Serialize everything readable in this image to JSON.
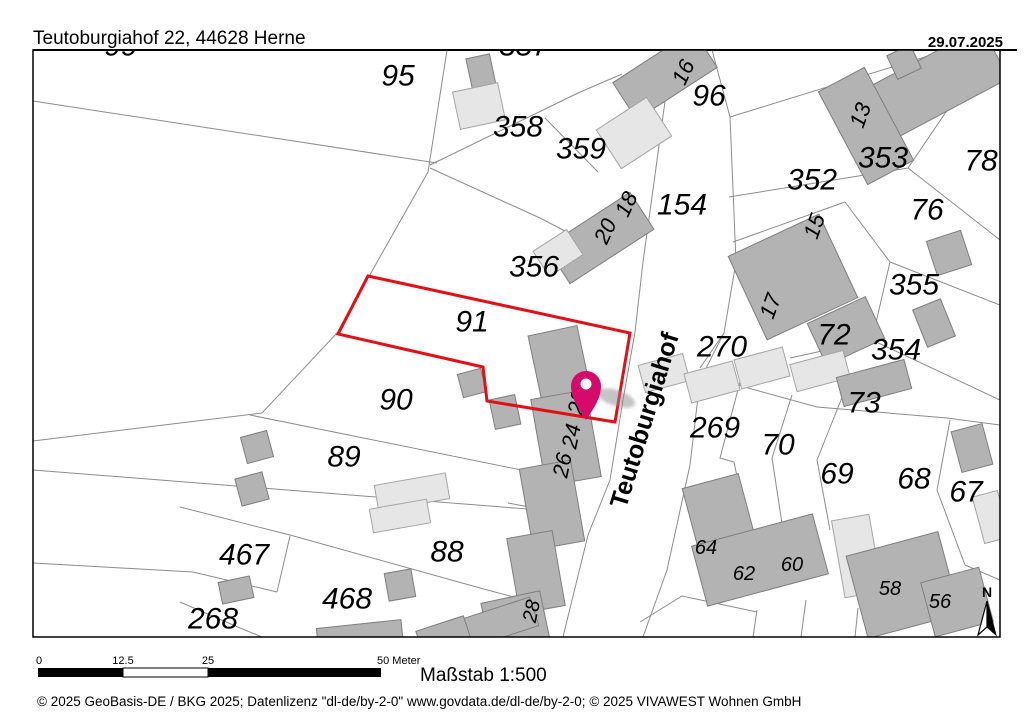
{
  "header": {
    "title": "Teutoburgiahof 22, 44628 Herne",
    "date": "29.07.2025"
  },
  "scalebar": {
    "tick0": "0",
    "tick1": "12.5",
    "tick2": "25",
    "tick3": "50 Meter",
    "caption": "Maßstab 1:500"
  },
  "footer": {
    "copyright": "© 2025 GeoBasis-DE / BKG  2025; Datenlizenz \"dl-de/by-2-0\" www.govdata.de/dl-de/by-2-0; © 2025 VIVAWEST Wohnen GmbH"
  },
  "north": {
    "label": "N"
  },
  "map": {
    "colors": {
      "building_dark": "#b3b3b3",
      "building_dark_stroke": "#7e7e7e",
      "building_light": "#e6e6e6",
      "building_light_stroke": "#a5a5a5",
      "parcel_line": "#8c8c8c",
      "selected_outline": "#e30f16",
      "pin": "#d60a6b",
      "text": "#000000"
    },
    "street_label": {
      "t": "Teutoburgiahof",
      "x": 644,
      "y": 420,
      "r": -73,
      "s": 25
    },
    "selected_parcel": {
      "points": [
        [
          368,
          276
        ],
        [
          630,
          333
        ],
        [
          615,
          422
        ],
        [
          487,
          401
        ],
        [
          483,
          367
        ],
        [
          338,
          334
        ]
      ],
      "stroke_width": 3
    },
    "pin": {
      "x": 586,
      "y": 420
    },
    "labels": [
      {
        "t": "95",
        "x": 398,
        "y": 75
      },
      {
        "t": "96",
        "x": 709,
        "y": 95
      },
      {
        "t": "358",
        "x": 518,
        "y": 126
      },
      {
        "t": "359",
        "x": 581,
        "y": 148
      },
      {
        "t": "353",
        "x": 883,
        "y": 157
      },
      {
        "t": "78",
        "x": 981,
        "y": 160
      },
      {
        "t": "352",
        "x": 812,
        "y": 179
      },
      {
        "t": "154",
        "x": 682,
        "y": 204
      },
      {
        "t": "76",
        "x": 927,
        "y": 209
      },
      {
        "t": "356",
        "x": 534,
        "y": 266
      },
      {
        "t": "355",
        "x": 914,
        "y": 284
      },
      {
        "t": "91",
        "x": 472,
        "y": 321
      },
      {
        "t": "72",
        "x": 834,
        "y": 334
      },
      {
        "t": "270",
        "x": 722,
        "y": 346
      },
      {
        "t": "354",
        "x": 896,
        "y": 349
      },
      {
        "t": "90",
        "x": 396,
        "y": 399
      },
      {
        "t": "73",
        "x": 864,
        "y": 402
      },
      {
        "t": "269",
        "x": 715,
        "y": 427
      },
      {
        "t": "70",
        "x": 778,
        "y": 444
      },
      {
        "t": "89",
        "x": 344,
        "y": 456
      },
      {
        "t": "69",
        "x": 837,
        "y": 473
      },
      {
        "t": "68",
        "x": 914,
        "y": 478
      },
      {
        "t": "67",
        "x": 966,
        "y": 491
      },
      {
        "t": "88",
        "x": 447,
        "y": 551
      },
      {
        "t": "467",
        "x": 244,
        "y": 554
      },
      {
        "t": "468",
        "x": 347,
        "y": 598
      },
      {
        "t": "268",
        "x": 213,
        "y": 618
      },
      {
        "t": "99",
        "x": 121,
        "y": 45
      },
      {
        "t": "357",
        "x": 524,
        "y": 45
      },
      {
        "t": "16",
        "x": 683,
        "y": 72,
        "r": -65,
        "s": 22,
        "h": 1
      },
      {
        "t": "13",
        "x": 860,
        "y": 115,
        "r": -70,
        "s": 22,
        "h": 1
      },
      {
        "t": "18",
        "x": 626,
        "y": 204,
        "r": -65,
        "s": 22,
        "h": 1
      },
      {
        "t": "20",
        "x": 605,
        "y": 231,
        "r": -65,
        "s": 22,
        "h": 1
      },
      {
        "t": "15",
        "x": 814,
        "y": 226,
        "r": -70,
        "s": 22,
        "h": 1
      },
      {
        "t": "17",
        "x": 770,
        "y": 306,
        "r": -70,
        "s": 22,
        "h": 1
      },
      {
        "t": "22",
        "x": 577,
        "y": 402,
        "r": -78,
        "s": 22,
        "h": 1
      },
      {
        "t": "24",
        "x": 571,
        "y": 436,
        "r": -78,
        "s": 22,
        "h": 1
      },
      {
        "t": "26",
        "x": 562,
        "y": 465,
        "r": -78,
        "s": 22,
        "h": 1
      },
      {
        "t": "28",
        "x": 531,
        "y": 611,
        "r": -78,
        "s": 20,
        "h": 1
      },
      {
        "t": "64",
        "x": 706,
        "y": 547,
        "s": 20,
        "h": 1
      },
      {
        "t": "62",
        "x": 744,
        "y": 573,
        "s": 20,
        "h": 1
      },
      {
        "t": "60",
        "x": 792,
        "y": 564,
        "s": 20,
        "h": 1
      },
      {
        "t": "58",
        "x": 890,
        "y": 588,
        "s": 20,
        "h": 1
      },
      {
        "t": "56",
        "x": 940,
        "y": 601,
        "s": 20,
        "h": 1
      }
    ],
    "buildings": [
      [
        481,
        72,
        24,
        32,
        -12,
        0
      ],
      [
        479,
        106,
        46,
        38,
        -12,
        1
      ],
      [
        665,
        75,
        96,
        44,
        -33,
        0
      ],
      [
        634,
        133,
        60,
        46,
        -33,
        1
      ],
      [
        600,
        238,
        100,
        44,
        -33,
        0
      ],
      [
        558,
        253,
        40,
        30,
        -33,
        1
      ],
      [
        940,
        82,
        125,
        58,
        -28,
        0
      ],
      [
        866,
        126,
        52,
        105,
        -28,
        0
      ],
      [
        904,
        62,
        26,
        26,
        -25,
        0
      ],
      [
        949,
        253,
        36,
        36,
        -18,
        0
      ],
      [
        793,
        277,
        100,
        92,
        -25,
        0
      ],
      [
        846,
        331,
        64,
        46,
        -25,
        0
      ],
      [
        934,
        323,
        30,
        40,
        -22,
        0
      ],
      [
        664,
        373,
        46,
        28,
        -15,
        1
      ],
      [
        712,
        382,
        50,
        30,
        -15,
        1
      ],
      [
        762,
        368,
        50,
        30,
        -15,
        1
      ],
      [
        820,
        371,
        55,
        28,
        -15,
        1
      ],
      [
        874,
        383,
        70,
        30,
        -15,
        0
      ],
      [
        560,
        366,
        50,
        72,
        -12,
        0
      ],
      [
        505,
        412,
        26,
        30,
        -12,
        0
      ],
      [
        566,
        438,
        56,
        88,
        -10,
        0
      ],
      [
        552,
        505,
        52,
        82,
        -10,
        0
      ],
      [
        536,
        572,
        46,
        76,
        -10,
        0
      ],
      [
        516,
        624,
        60,
        55,
        -12,
        0
      ],
      [
        489,
        626,
        95,
        30,
        -18,
        0
      ],
      [
        472,
        383,
        24,
        24,
        -15,
        0
      ],
      [
        257,
        447,
        27,
        27,
        -15,
        0
      ],
      [
        252,
        489,
        28,
        28,
        -15,
        0
      ],
      [
        236,
        590,
        32,
        22,
        -12,
        0
      ],
      [
        412,
        492,
        72,
        26,
        -10,
        1
      ],
      [
        400,
        516,
        58,
        24,
        -10,
        1
      ],
      [
        400,
        585,
        27,
        28,
        -10,
        0
      ],
      [
        360,
        637,
        85,
        26,
        -6,
        0
      ],
      [
        443,
        634,
        50,
        22,
        -18,
        0
      ],
      [
        719,
        514,
        58,
        68,
        -15,
        0
      ],
      [
        760,
        560,
        125,
        62,
        -15,
        0
      ],
      [
        857,
        556,
        38,
        78,
        -10,
        1
      ],
      [
        903,
        585,
        95,
        85,
        -15,
        0
      ],
      [
        957,
        602,
        60,
        56,
        -15,
        0
      ],
      [
        991,
        517,
        26,
        48,
        -15,
        1
      ],
      [
        972,
        448,
        32,
        42,
        -15,
        0
      ]
    ],
    "lines": [
      [
        [
          33,
          101
        ],
        [
          437,
          163
        ]
      ],
      [
        [
          447,
          50
        ],
        [
          428,
          172
        ]
      ],
      [
        [
          428,
          172
        ],
        [
          337,
          333
        ]
      ],
      [
        [
          337,
          333
        ],
        [
          262,
          413
        ]
      ],
      [
        [
          262,
          413
        ],
        [
          33,
          441
        ]
      ],
      [
        [
          250,
          415
        ],
        [
          556,
          477
        ]
      ],
      [
        [
          33,
          470
        ],
        [
          540,
          510
        ]
      ],
      [
        [
          180,
          507
        ],
        [
          290,
          535
        ],
        [
          480,
          588
        ],
        [
          525,
          600
        ]
      ],
      [
        [
          290,
          536
        ],
        [
          277,
          592
        ]
      ],
      [
        [
          33,
          563
        ],
        [
          193,
          572
        ],
        [
          277,
          592
        ]
      ],
      [
        [
          180,
          602
        ],
        [
          240,
          628
        ],
        [
          262,
          637
        ]
      ],
      [
        [
          430,
          165
        ],
        [
          578,
          93
        ],
        [
          622,
          74
        ]
      ],
      [
        [
          545,
          118
        ],
        [
          598,
          172
        ]
      ],
      [
        [
          430,
          168
        ],
        [
          540,
          218
        ],
        [
          588,
          243
        ]
      ],
      [
        [
          672,
          50
        ],
        [
          655,
          175
        ],
        [
          643,
          262
        ],
        [
          635,
          332
        ],
        [
          623,
          400
        ],
        [
          610,
          480
        ],
        [
          588,
          535
        ],
        [
          563,
          637
        ]
      ],
      [
        [
          712,
          50
        ],
        [
          730,
          117
        ],
        [
          736,
          262
        ],
        [
          724,
          333
        ],
        [
          700,
          380
        ],
        [
          690,
          465
        ],
        [
          667,
          570
        ],
        [
          643,
          637
        ]
      ],
      [
        [
          730,
          117
        ],
        [
          892,
          67
        ],
        [
          948,
          50
        ]
      ],
      [
        [
          729,
          197
        ],
        [
          908,
          168
        ]
      ],
      [
        [
          908,
          168
        ],
        [
          950,
          106
        ],
        [
          963,
          50
        ]
      ],
      [
        [
          908,
          168
        ],
        [
          1000,
          240
        ]
      ],
      [
        [
          733,
          242
        ],
        [
          845,
          202
        ]
      ],
      [
        [
          845,
          202
        ],
        [
          890,
          262
        ]
      ],
      [
        [
          890,
          262
        ],
        [
          1000,
          305
        ]
      ],
      [
        [
          890,
          262
        ],
        [
          872,
          340
        ]
      ],
      [
        [
          872,
          340
        ],
        [
          1000,
          400
        ]
      ],
      [
        [
          790,
          358
        ],
        [
          872,
          340
        ]
      ],
      [
        [
          724,
          333
        ],
        [
          700,
          368
        ]
      ],
      [
        [
          700,
          374
        ],
        [
          748,
          388
        ]
      ],
      [
        [
          748,
          388
        ],
        [
          817,
          407
        ],
        [
          947,
          418
        ],
        [
          1000,
          425
        ]
      ],
      [
        [
          740,
          382
        ],
        [
          720,
          458
        ],
        [
          734,
          462
        ],
        [
          748,
          530
        ]
      ],
      [
        [
          792,
          395
        ],
        [
          772,
          458
        ],
        [
          783,
          530
        ]
      ],
      [
        [
          843,
          395
        ],
        [
          817,
          460
        ],
        [
          830,
          530
        ]
      ],
      [
        [
          950,
          420
        ],
        [
          937,
          490
        ],
        [
          965,
          565
        ]
      ],
      [
        [
          965,
          565
        ],
        [
          1000,
          580
        ]
      ],
      [
        [
          640,
          622
        ],
        [
          682,
          596
        ],
        [
          757,
          612
        ]
      ],
      [
        [
          757,
          610
        ],
        [
          753,
          637
        ]
      ],
      [
        [
          806,
          600
        ],
        [
          801,
          637
        ]
      ],
      [
        [
          858,
          608
        ],
        [
          855,
          637
        ]
      ],
      [
        [
          508,
          503
        ],
        [
          556,
          512
        ]
      ]
    ]
  }
}
